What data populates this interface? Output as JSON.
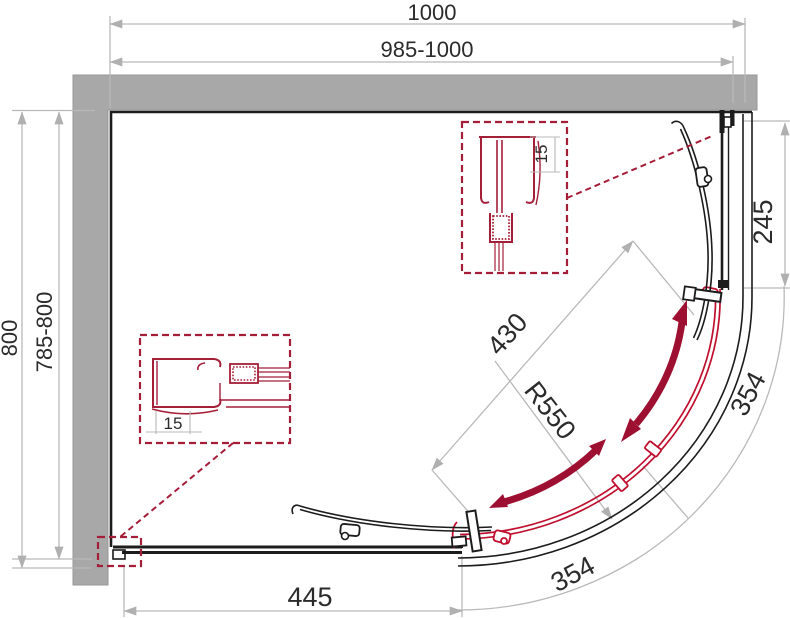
{
  "drawing": {
    "dimensions": {
      "width_total": "1000",
      "width_adjustable": "985-1000",
      "depth_total": "800",
      "depth_adjustable": "785-800",
      "right_panel": "245",
      "door_width": "430",
      "radius": "R550",
      "arc_right": "354",
      "arc_bottom": "354",
      "bottom_panel": "445",
      "detail_top_profile": "15",
      "detail_left_profile": "15"
    },
    "colors": {
      "wall": "#a8a8a8",
      "outline": "#1c1c1c",
      "dimension_lines": "#b9b9b9",
      "accent_red": "#a51e38",
      "door_red": "#c00f2e",
      "arrow_red": "#9e1031",
      "text": "#2b2b2b",
      "background": "#ffffff"
    }
  }
}
